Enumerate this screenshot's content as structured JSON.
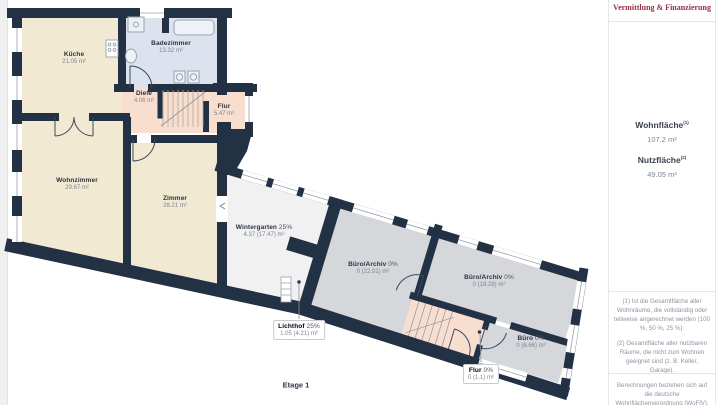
{
  "colors": {
    "wall": "#233145",
    "room_beige": "#f1e9d2",
    "room_bath": "#dce3ef",
    "room_pink": "#f8decf",
    "room_neutral": "#f1f1f2",
    "room_office": "#d5d7da",
    "glass_line": "#98a0ac",
    "brand_accent": "#9d2f47"
  },
  "floorplan": {
    "caption": "Etage 1",
    "rooms": {
      "kueche": {
        "name": "Küche",
        "suffix": "",
        "area": "21.05 m²"
      },
      "badezimmer": {
        "name": "Badezimmer",
        "suffix": "",
        "area": "13.32 m²"
      },
      "diele": {
        "name": "Diele",
        "suffix": "",
        "area": "4.06 m²"
      },
      "flur_og": {
        "name": "Flur",
        "suffix": "",
        "area": "5.47 m²"
      },
      "wohnzimmer": {
        "name": "Wohnzimmer",
        "suffix": "",
        "area": "29.67 m²"
      },
      "zimmer": {
        "name": "Zimmer",
        "suffix": "",
        "area": "28.21 m²"
      },
      "wintergarten": {
        "name": "Wintergarten",
        "suffix": "25%",
        "area": "4.37 (17.47) m²"
      },
      "buero_archiv_1": {
        "name": "Büro/Archiv",
        "suffix": "0%",
        "area": "0 (22.01) m²"
      },
      "buero_archiv_2": {
        "name": "Büro/Archiv",
        "suffix": "0%",
        "area": "0 (19.28) m²"
      },
      "buero": {
        "name": "Büro",
        "suffix": "0%",
        "area": "0 (6.66) m²"
      },
      "lichthof": {
        "name": "Lichthof",
        "suffix": "25%",
        "area": "1.05 (4.21) m²"
      },
      "flur_eg": {
        "name": "Flur",
        "suffix": "0%",
        "area": "0 (1.1) m²"
      }
    }
  },
  "sidebar": {
    "brand": "Vermittlung & Finanzierung",
    "wohnflaeche_label": "Wohnfläche",
    "wohnflaeche_sup": "(1)",
    "wohnflaeche_value": "107.2 m²",
    "nutzflaeche_label": "Nutzfläche",
    "nutzflaeche_sup": "(2)",
    "nutzflaeche_value": "49.05 m²",
    "footnote1": "(1) Ist die Gesamtfläche aller Wohnräume, die vollständig oder teilweise angerechnet werden (100 %, 50 %, 25 %).",
    "footnote2": "(2) Gesamtfläche aller nutzbaren Räume, die nicht zum Wohnen geeignet sind (z. B. Keller, Garage).",
    "disclaimer": "Berechnungen beziehen sich auf die deutsche Wohnflächenverordnung (WoFlV). Maße sind ungefähre Angaben"
  }
}
